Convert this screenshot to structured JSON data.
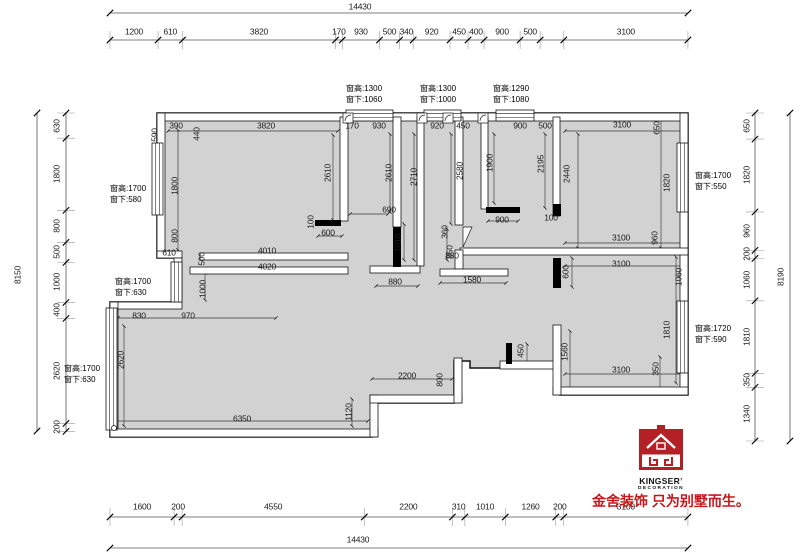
{
  "chains": {
    "top": {
      "values": [
        1200,
        610,
        3820,
        170,
        930,
        500,
        340,
        920,
        450,
        400,
        900,
        500,
        590,
        3100
      ],
      "labels": [
        "1200",
        "610",
        "3820",
        "170",
        "930",
        "500",
        "340",
        "920",
        "450",
        "400",
        "900",
        "500",
        "",
        "3100"
      ]
    },
    "bottom": {
      "values": [
        1600,
        200,
        4550,
        2200,
        310,
        1010,
        1260,
        200,
        3100
      ],
      "labels": [
        "1600",
        "200",
        "4550",
        "2200",
        "310",
        "1010",
        "1260",
        "200",
        "3100"
      ]
    },
    "left": {
      "values": [
        630,
        1800,
        800,
        500,
        1000,
        400,
        2620,
        200
      ],
      "labels": [
        "630",
        "1800",
        "800",
        "500",
        "1000",
        "400",
        "2620",
        "200"
      ]
    },
    "right": {
      "values": [
        650,
        1820,
        960,
        200,
        1060,
        1810,
        350,
        1340
      ],
      "labels": [
        "650",
        "1820",
        "960",
        "200",
        "1060",
        "1810",
        "350",
        "1340"
      ]
    }
  },
  "totals": {
    "top": "14430",
    "bottom": "14430",
    "left": "8150",
    "right": "8190"
  },
  "interior_dims": [
    {
      "t": "590",
      "x": 155,
      "y": 135,
      "r": 1
    },
    {
      "t": "390",
      "x": 176,
      "y": 126,
      "r": 0
    },
    {
      "t": "440",
      "x": 197,
      "y": 134,
      "r": 1
    },
    {
      "t": "3820",
      "x": 266,
      "y": 126,
      "r": 0
    },
    {
      "t": "170",
      "x": 352,
      "y": 126,
      "r": 0
    },
    {
      "t": "930",
      "x": 379,
      "y": 126,
      "r": 0
    },
    {
      "t": "920",
      "x": 437,
      "y": 126,
      "r": 0
    },
    {
      "t": "450",
      "x": 463,
      "y": 126,
      "r": 0
    },
    {
      "t": "900",
      "x": 520,
      "y": 126,
      "r": 0
    },
    {
      "t": "500",
      "x": 545,
      "y": 126,
      "r": 0
    },
    {
      "t": "3100",
      "x": 622,
      "y": 125,
      "r": 0
    },
    {
      "t": "1800",
      "x": 175,
      "y": 186,
      "r": 1
    },
    {
      "t": "800",
      "x": 175,
      "y": 236,
      "r": 1
    },
    {
      "t": "610",
      "x": 169,
      "y": 253,
      "r": 0
    },
    {
      "t": "2610",
      "x": 328,
      "y": 173,
      "r": 1
    },
    {
      "t": "100",
      "x": 311,
      "y": 222,
      "r": 1
    },
    {
      "t": "600",
      "x": 328,
      "y": 233,
      "r": 0
    },
    {
      "t": "4010",
      "x": 267,
      "y": 251,
      "r": 0
    },
    {
      "t": "500",
      "x": 202,
      "y": 259,
      "r": 1
    },
    {
      "t": "4020",
      "x": 267,
      "y": 267,
      "r": 0
    },
    {
      "t": "1000",
      "x": 203,
      "y": 289,
      "r": 1
    },
    {
      "t": "830",
      "x": 139,
      "y": 316,
      "r": 0
    },
    {
      "t": "970",
      "x": 188,
      "y": 316,
      "r": 0
    },
    {
      "t": "2620",
      "x": 121,
      "y": 360,
      "r": 1
    },
    {
      "t": "6350",
      "x": 242,
      "y": 419,
      "r": 0
    },
    {
      "t": "1120",
      "x": 349,
      "y": 412,
      "r": 1
    },
    {
      "t": "2200",
      "x": 407,
      "y": 376,
      "r": 0
    },
    {
      "t": "800",
      "x": 440,
      "y": 380,
      "r": 1
    },
    {
      "t": "2610",
      "x": 389,
      "y": 173,
      "r": 1
    },
    {
      "t": "2710",
      "x": 414,
      "y": 177,
      "r": 1
    },
    {
      "t": "690",
      "x": 389,
      "y": 210,
      "r": 0
    },
    {
      "t": "1010",
      "x": 398,
      "y": 243,
      "r": 1
    },
    {
      "t": "880",
      "x": 395,
      "y": 282,
      "r": 0
    },
    {
      "t": "2580",
      "x": 460,
      "y": 171,
      "r": 1
    },
    {
      "t": "360",
      "x": 445,
      "y": 232,
      "r": 1
    },
    {
      "t": "850",
      "x": 450,
      "y": 252,
      "r": 1
    },
    {
      "t": "880",
      "x": 452,
      "y": 256,
      "r": 0
    },
    {
      "t": "1580",
      "x": 472,
      "y": 280,
      "r": 0
    },
    {
      "t": "900",
      "x": 502,
      "y": 220,
      "r": 0
    },
    {
      "t": "1900",
      "x": 490,
      "y": 163,
      "r": 1
    },
    {
      "t": "2195",
      "x": 541,
      "y": 164,
      "r": 1
    },
    {
      "t": "100",
      "x": 551,
      "y": 218,
      "r": 0
    },
    {
      "t": "2440",
      "x": 567,
      "y": 174,
      "r": 1
    },
    {
      "t": "650",
      "x": 657,
      "y": 128,
      "r": 1
    },
    {
      "t": "1820",
      "x": 667,
      "y": 183,
      "r": 1
    },
    {
      "t": "3100",
      "x": 621,
      "y": 238,
      "r": 0
    },
    {
      "t": "960",
      "x": 655,
      "y": 238,
      "r": 1
    },
    {
      "t": "3100",
      "x": 621,
      "y": 264,
      "r": 0
    },
    {
      "t": "600",
      "x": 566,
      "y": 272,
      "r": 1
    },
    {
      "t": "1060",
      "x": 679,
      "y": 277,
      "r": 1
    },
    {
      "t": "1810",
      "x": 667,
      "y": 330,
      "r": 1
    },
    {
      "t": "1560",
      "x": 565,
      "y": 352,
      "r": 1
    },
    {
      "t": "450",
      "x": 521,
      "y": 351,
      "r": 1
    },
    {
      "t": "3100",
      "x": 621,
      "y": 370,
      "r": 0
    },
    {
      "t": "350",
      "x": 656,
      "y": 369,
      "r": 1
    }
  ],
  "window_notes": [
    {
      "l1": "窗高:1300",
      "l2": "窗下:1060",
      "x": 346,
      "y": 83
    },
    {
      "l1": "窗高:1300",
      "l2": "窗下:1000",
      "x": 420,
      "y": 83
    },
    {
      "l1": "窗高:1290",
      "l2": "窗下:1080",
      "x": 493,
      "y": 83
    },
    {
      "l1": "窗高:1700",
      "l2": "窗下:580",
      "x": 110,
      "y": 183
    },
    {
      "l1": "窗高:1700",
      "l2": "窗下:630",
      "x": 115,
      "y": 276
    },
    {
      "l1": "窗高:1700",
      "l2": "窗下:630",
      "x": 64,
      "y": 363
    },
    {
      "l1": "窗高:1700",
      "l2": "窗下:550",
      "x": 695,
      "y": 170
    },
    {
      "l1": "窗高:1720",
      "l2": "窗下:590",
      "x": 695,
      "y": 323
    }
  ],
  "logo": {
    "brand": "KINGSER",
    "apostrophe": "’",
    "sub": "DECORATION",
    "slogan": "金舍装饰 只为别墅而生。"
  },
  "colors": {
    "brand_red": "#b32025",
    "slogan_red": "#c8171c",
    "plan_fill": "#d2d2d2"
  }
}
